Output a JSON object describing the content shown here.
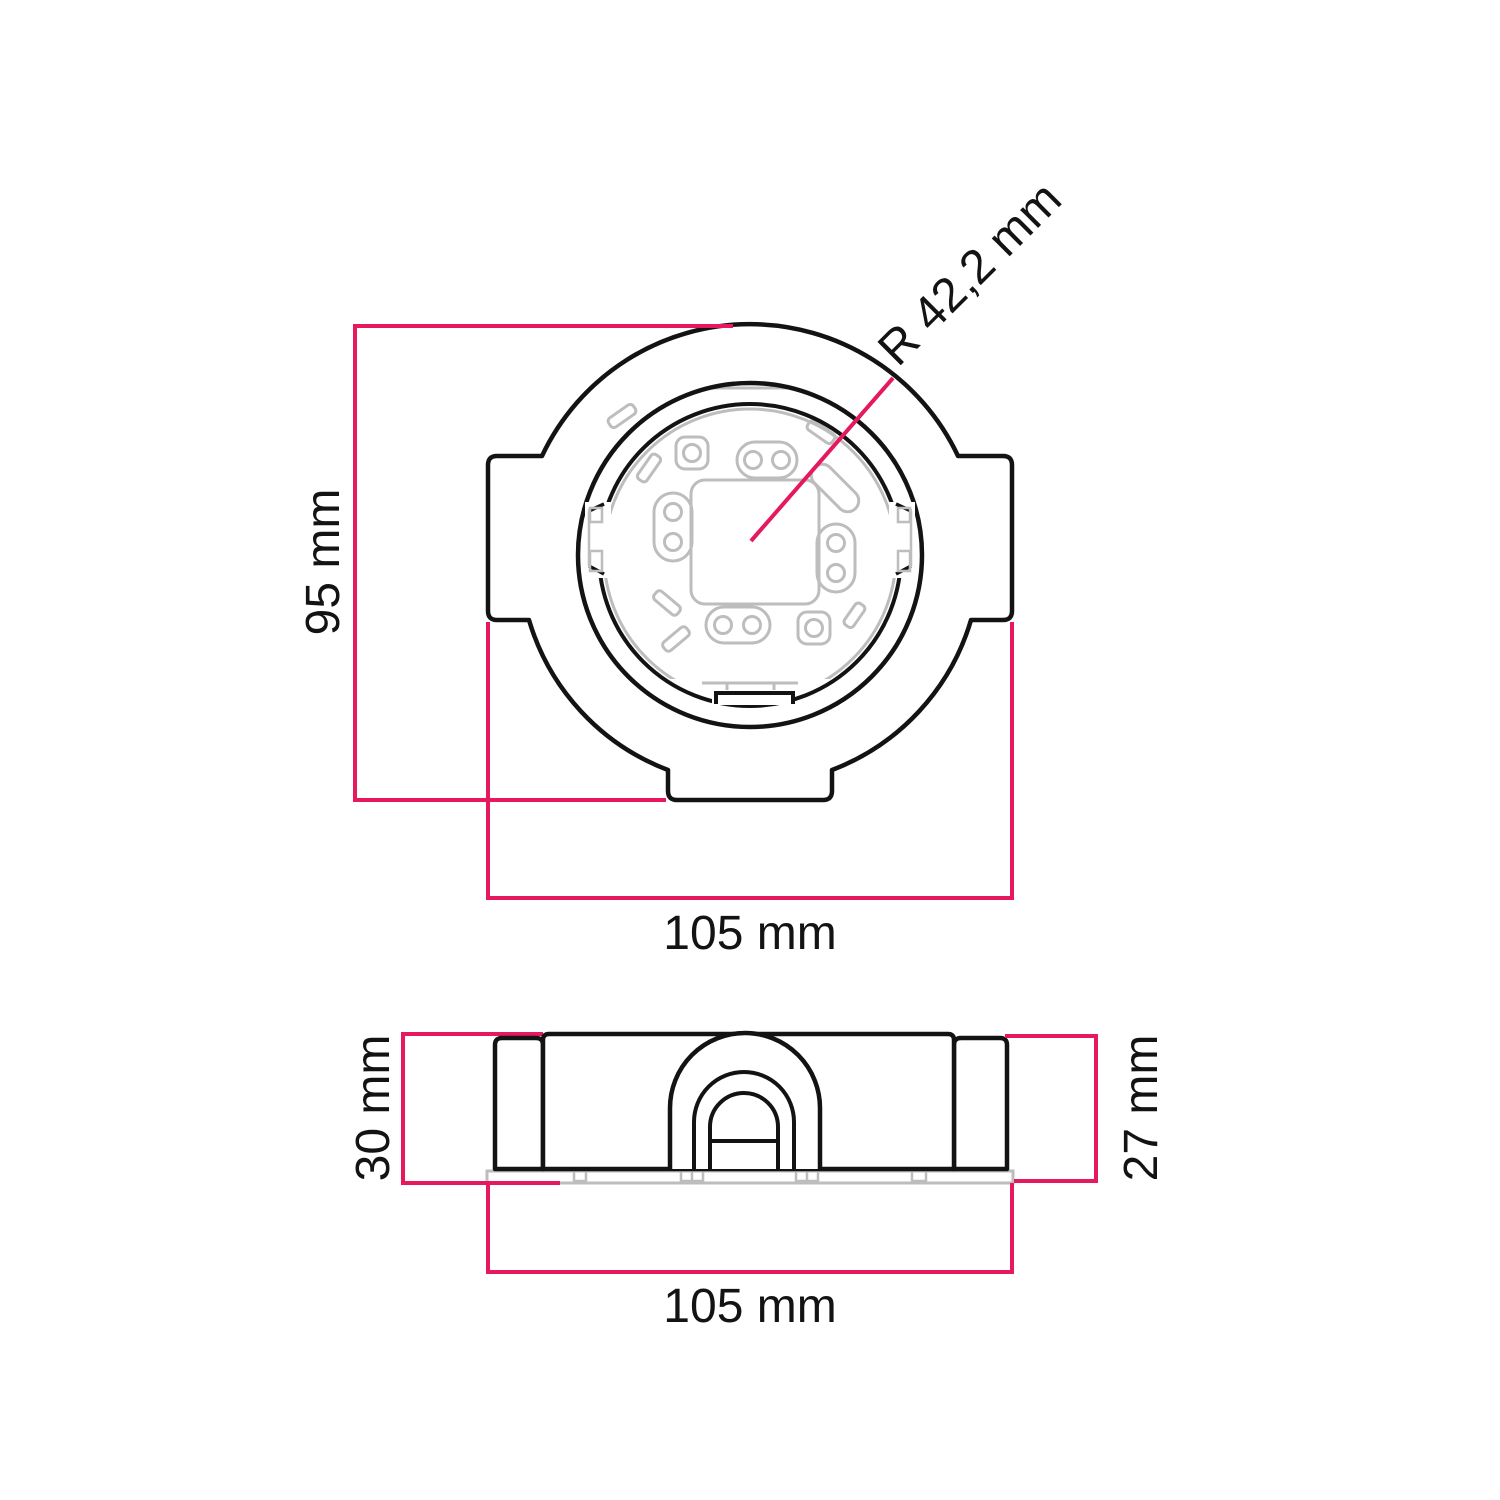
{
  "drawing": {
    "colors": {
      "outline": "#131313",
      "dimension_line": "#e5195c",
      "inner_detail": "#bdbdbd",
      "background": "#ffffff"
    },
    "top_view": {
      "height_label": "95 mm",
      "width_label": "105 mm",
      "radius_label": "R 42,2 mm"
    },
    "side_view": {
      "height_left_label": "30 mm",
      "height_right_label": "27 mm",
      "width_label": "105 mm"
    }
  }
}
